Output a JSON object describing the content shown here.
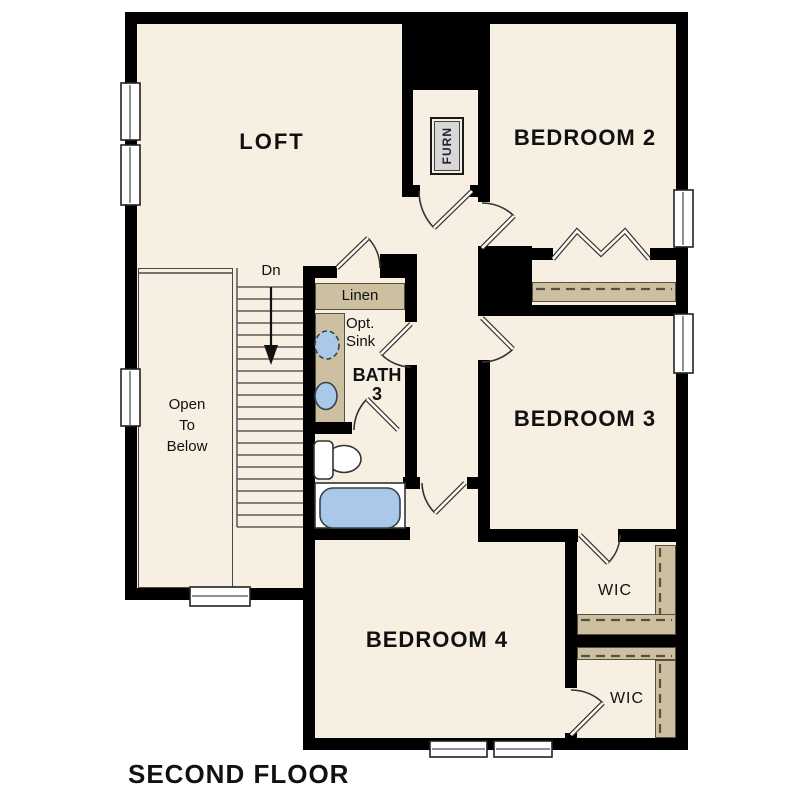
{
  "title": "SECOND FLOOR",
  "rooms": {
    "loft": "LOFT",
    "bedroom2": "BEDROOM 2",
    "bedroom3": "BEDROOM 3",
    "bedroom4": "BEDROOM 4",
    "bath_line1": "BATH",
    "bath_line2": "3",
    "wic_upper": "WIC",
    "wic_lower": "WIC"
  },
  "annotations": {
    "linen": "Linen",
    "opt_sink_line1": "Opt.",
    "opt_sink_line2": "Sink",
    "furnace": "FURN",
    "stairs_direction": "Dn",
    "open_to_below_line1": "Open",
    "open_to_below_line2": "To",
    "open_to_below_line3": "Below"
  },
  "colors": {
    "background": "#ffffff",
    "floor": "#f7efe2",
    "wall": "#000000",
    "shelf": "#cdc0a1",
    "fixture": "#aac9e9",
    "furnace_fill": "#d7d7d7",
    "text": "#111111"
  }
}
